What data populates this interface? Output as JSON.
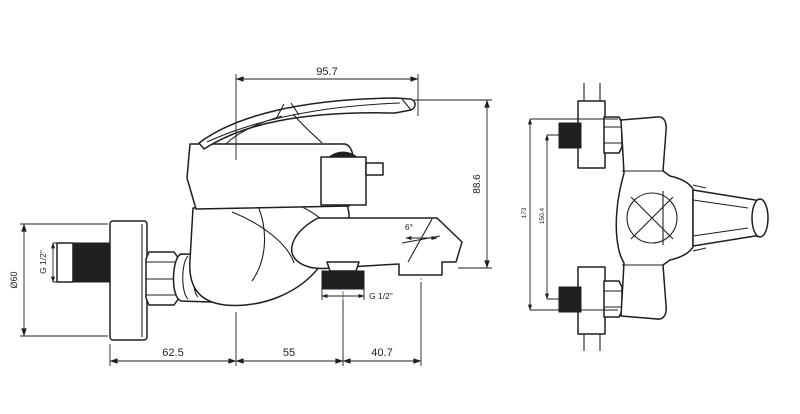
{
  "colors": {
    "line": "#1f1f1f",
    "centerline": "#bf6a30",
    "background": "#ffffff"
  },
  "front_view": {
    "dim_handle_width": "95.7",
    "dim_height": "88.6",
    "dim_flange_diameter": "Ø60",
    "dim_inlet_thread": "G 1/2\"",
    "dim_shower_outlet_thread": "G 1/2\"",
    "dim_wall_to_center": "62.5",
    "dim_center_to_outlet": "55",
    "dim_outlet_to_spout": "40.7",
    "dim_spout_angle": "6°"
  },
  "side_view": {
    "dim_overall_height": "173",
    "dim_inlet_spacing": "150.4"
  }
}
